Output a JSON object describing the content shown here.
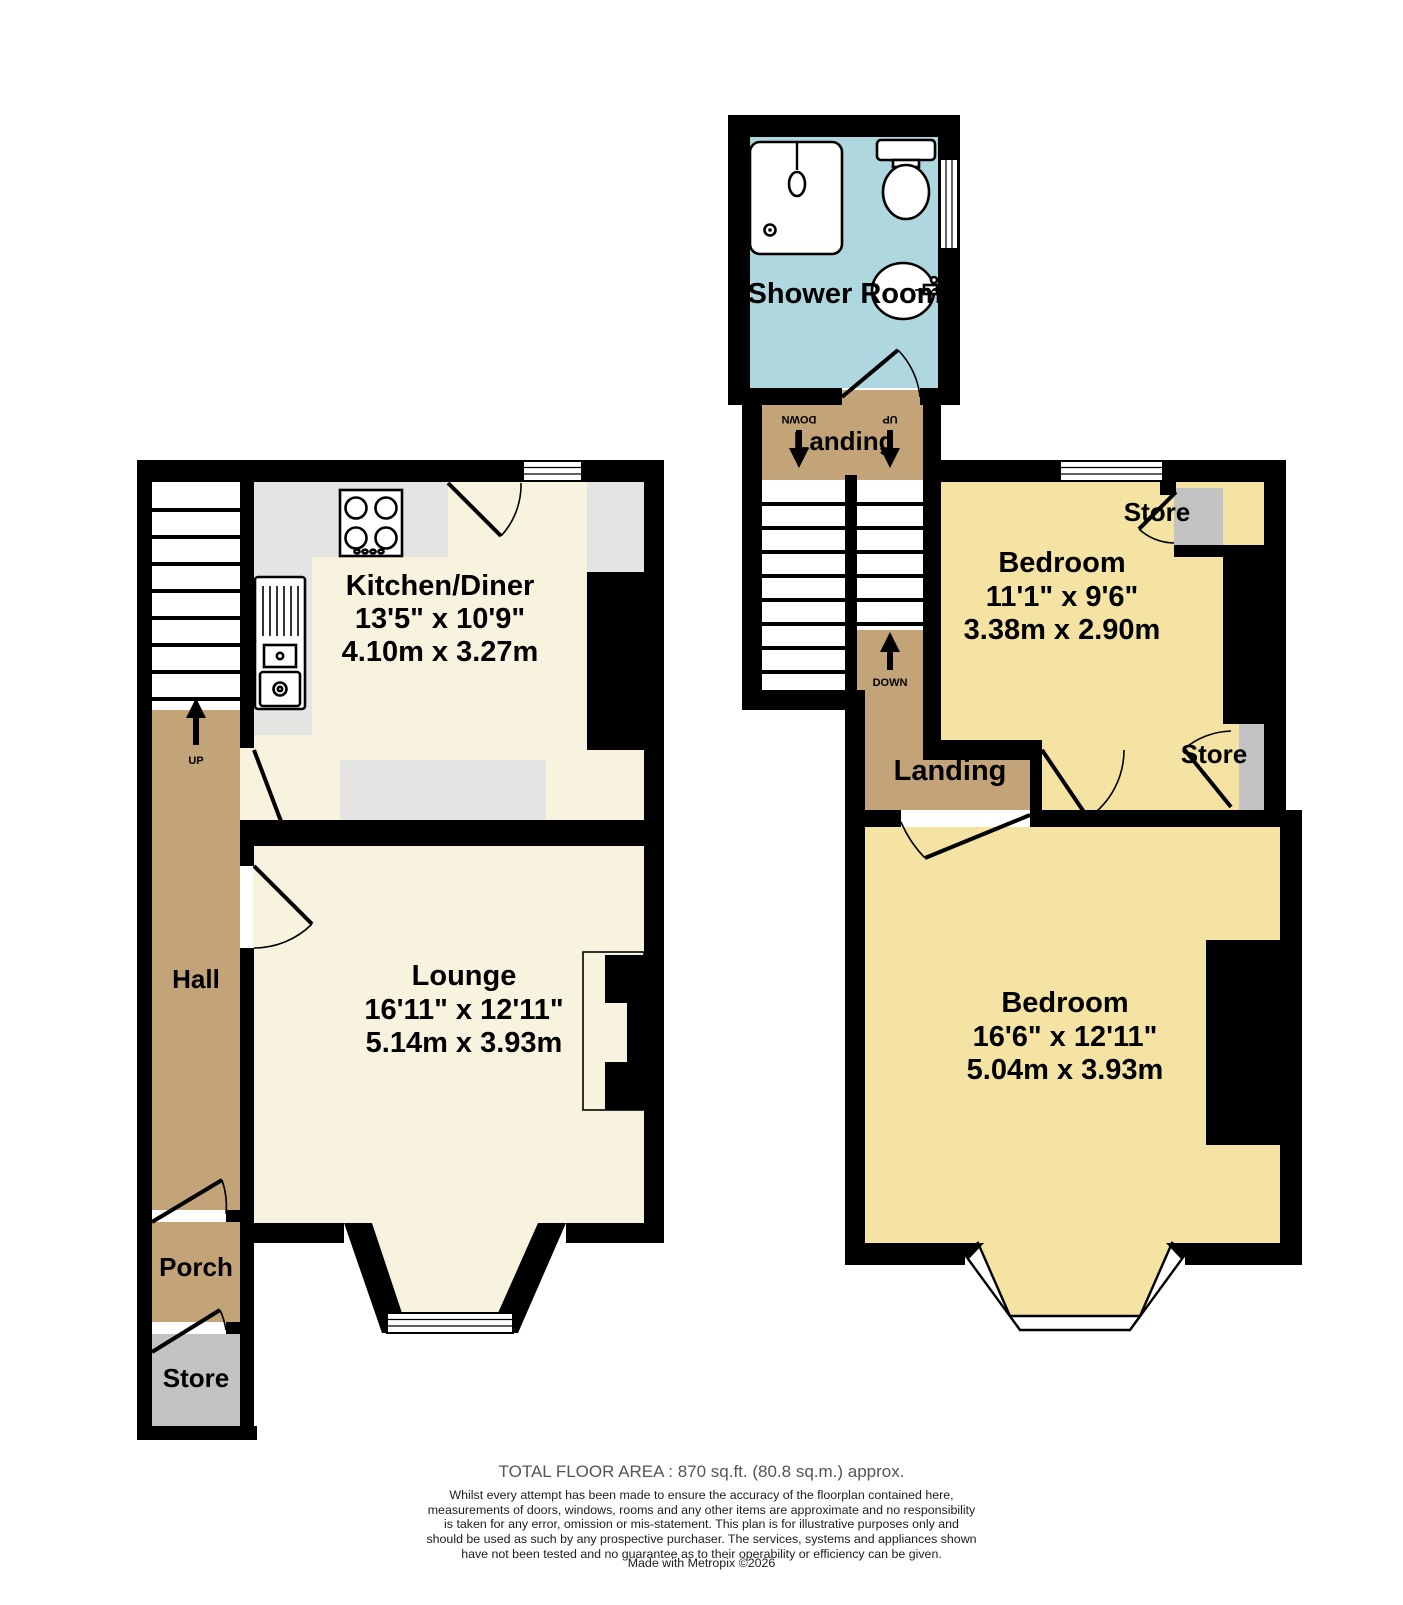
{
  "colors": {
    "wall": "#000000",
    "ground_room_cream": "#F8F3DF",
    "bedroom_yellow": "#F4E3A3",
    "hall_tan": "#C3A478",
    "shower_blue": "#AFD7DF",
    "store_grey": "#C2C2C2",
    "counter_grey": "#E4E4E2",
    "footer_grey": "#555555"
  },
  "ground_floor": {
    "stairs_label": "UP",
    "hall": {
      "name": "Hall"
    },
    "porch": {
      "name": "Porch"
    },
    "store": {
      "name": "Store"
    },
    "kitchen": {
      "name": "Kitchen/Diner",
      "imperial": "13'5\"  x 10'9\"",
      "metric": "4.10m  x 3.27m"
    },
    "lounge": {
      "name": "Lounge",
      "imperial": "16'11\"  x 12'11\"",
      "metric": "5.14m  x 3.93m"
    }
  },
  "first_floor": {
    "shower_room": {
      "name": "Shower Room"
    },
    "top_landing": {
      "name": "Landing",
      "left_arrow_label": "DOWN",
      "right_arrow_label": "UP"
    },
    "mid_landing": {
      "name": "Landing",
      "arrow_label": "DOWN"
    },
    "bedroom_back": {
      "name": "Bedroom",
      "imperial": "11'1\"  x 9'6\"",
      "metric": "3.38m  x 2.90m"
    },
    "bedroom_front": {
      "name": "Bedroom",
      "imperial": "16'6\"  x 12'11\"",
      "metric": "5.04m  x 3.93m"
    },
    "store_upper": {
      "name": "Store"
    },
    "store_lower": {
      "name": "Store"
    }
  },
  "footer": {
    "total_area": "TOTAL FLOOR AREA : 870 sq.ft. (80.8 sq.m.) approx.",
    "disclaimer": "Whilst every attempt has been made to ensure the accuracy of the floorplan contained here, measurements of doors, windows, rooms and any other items are approximate and no responsibility is taken for any error, omission or mis-statement. This plan is for illustrative purposes only and should be used as such by any prospective purchaser. The services, systems and appliances shown have not been tested and no guarantee as to their operability or efficiency can be given.",
    "credit": "Made with Metropix ©2026"
  }
}
